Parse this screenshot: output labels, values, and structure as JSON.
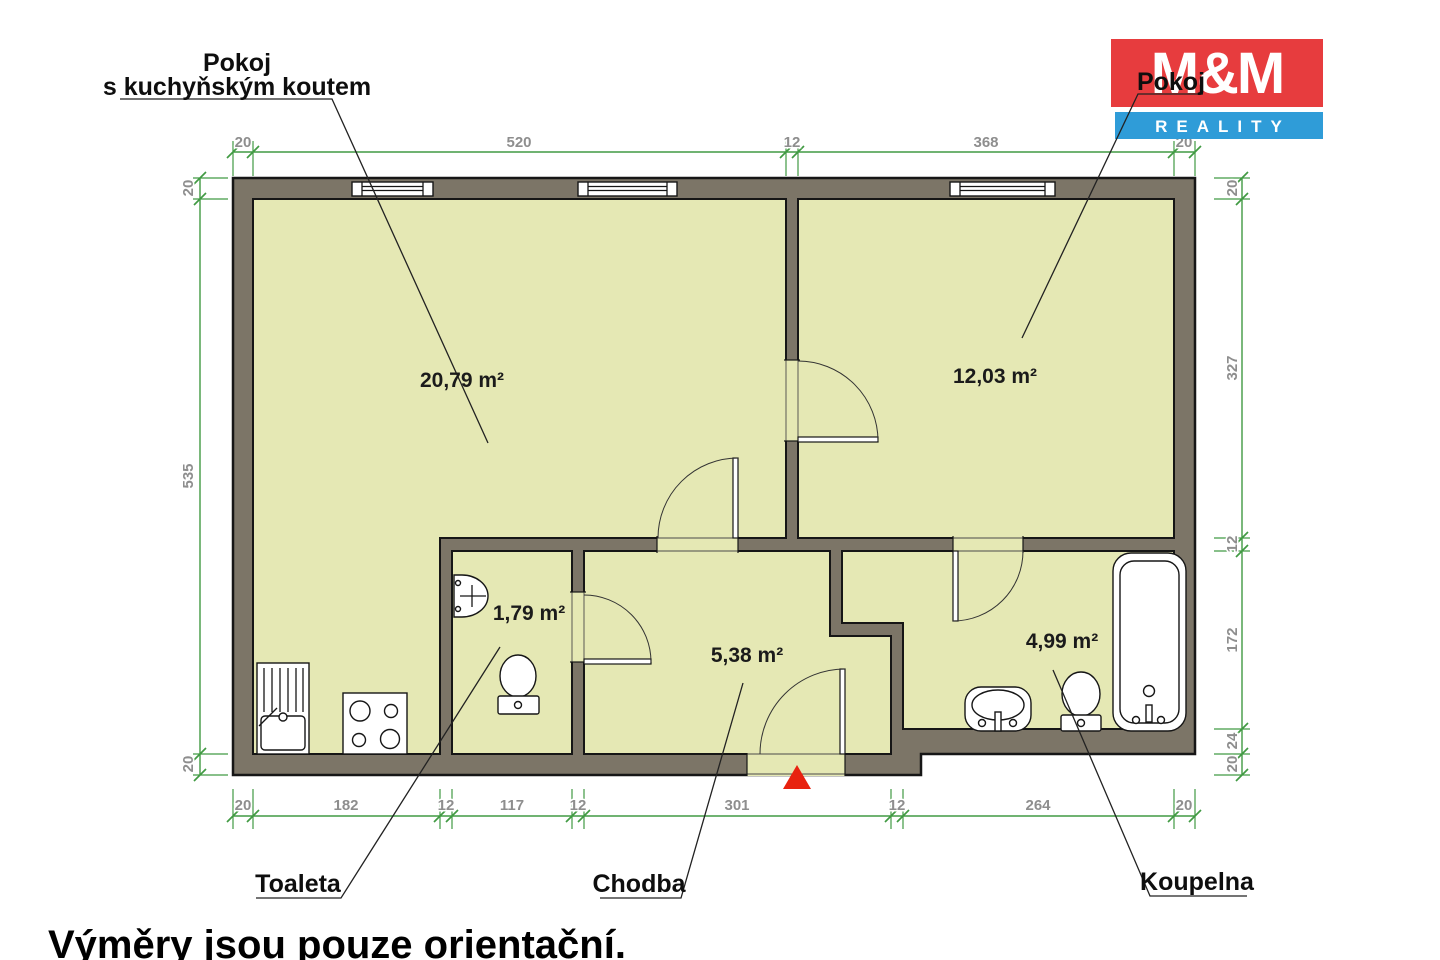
{
  "logo": {
    "line1": "M&M",
    "line2": "REALITY",
    "red": "#e73c3e",
    "blue": "#2f9cd8"
  },
  "footer": {
    "note": "Výměry jsou pouze orientační."
  },
  "rooms": {
    "kitchen_room": {
      "label_line1": "Pokoj",
      "label_line2": "s kuchyňským koutem",
      "area": "20,79 m²"
    },
    "room": {
      "label": "Pokoj",
      "area": "12,03 m²"
    },
    "toilet": {
      "label": "Toaleta",
      "area": "1,79 m²"
    },
    "hallway": {
      "label": "Chodba",
      "area": "5,38 m²"
    },
    "bathroom": {
      "label": "Koupelna",
      "area": "4,99 m²"
    }
  },
  "dimensions": {
    "top": [
      "20",
      "520",
      "12",
      "368",
      "20"
    ],
    "bottom": [
      "20",
      "182",
      "12",
      "117",
      "12",
      "301",
      "12",
      "264",
      "20"
    ],
    "left": [
      "20",
      "535",
      "20"
    ],
    "right": [
      "20",
      "327",
      "12",
      "172",
      "24",
      "20"
    ]
  },
  "colors": {
    "wall": "#7c7567",
    "floor": "#e5e8b4",
    "dimension": "#419a43",
    "entrance_marker": "#e8220f"
  }
}
